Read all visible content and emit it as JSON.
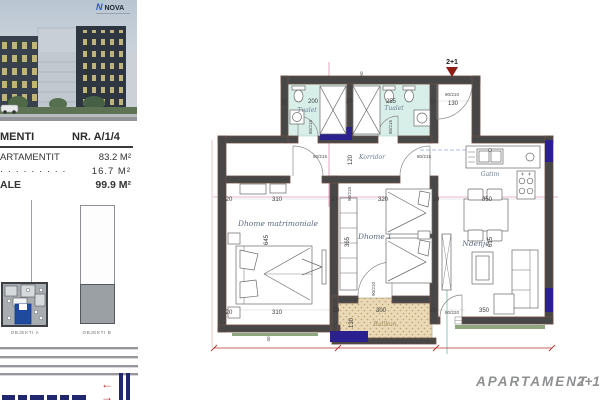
{
  "colors": {
    "accent_navy": "#20276f",
    "highlight_wall": "#2a2090",
    "dimension_red": "#b8322a",
    "bathroom_floor": "#d8efe9",
    "balcony_floor": "#e9d9b6",
    "wall": "#474747",
    "exterior_trim": "#6e4f46",
    "keyplan_unit_blue": "#1f4a9e",
    "green_ledge": "#8fa77f"
  },
  "logo": {
    "mark": "N",
    "brand": "NOVA"
  },
  "info": {
    "header_label": "MENTI",
    "header_number": "NR. A/1/4",
    "rows": [
      {
        "label": "ARTAMENTIT",
        "value": "83.2 M²"
      },
      {
        "label": "· · · · · · · · ·",
        "value": "16.7 M²"
      },
      {
        "label": "ALE",
        "value": "99.9 M²"
      }
    ]
  },
  "keyplan": {
    "objekti_a": "OBJEKTI A",
    "objekti_b": "OBJEKTI B"
  },
  "icons": {
    "arrow_left": "←",
    "arrow_right": "→"
  },
  "plan": {
    "entry_type": "2+1",
    "rooms": {
      "tualet": "Tualet",
      "korridor": "Korridor",
      "master": "Dhome matrimoniale",
      "dhome1": "Dhome 1",
      "ndenje": "Ndenje",
      "gatim": "Gatim",
      "ballkon": "Ballkon"
    },
    "dims": [
      "20",
      "200",
      "10",
      "255",
      "10",
      "90/210",
      "130",
      "50",
      "120",
      "80/215",
      "80/215",
      "80/215",
      "80/215",
      "90/215",
      "20",
      "310",
      "10",
      "320",
      "10",
      "350",
      "645",
      "365",
      "615",
      "20",
      "310",
      "300",
      "20",
      "20",
      "80/220",
      "350",
      "130",
      "90/210",
      "40"
    ]
  },
  "footer": {
    "title": "APARTAMENT",
    "type": "2+1"
  }
}
